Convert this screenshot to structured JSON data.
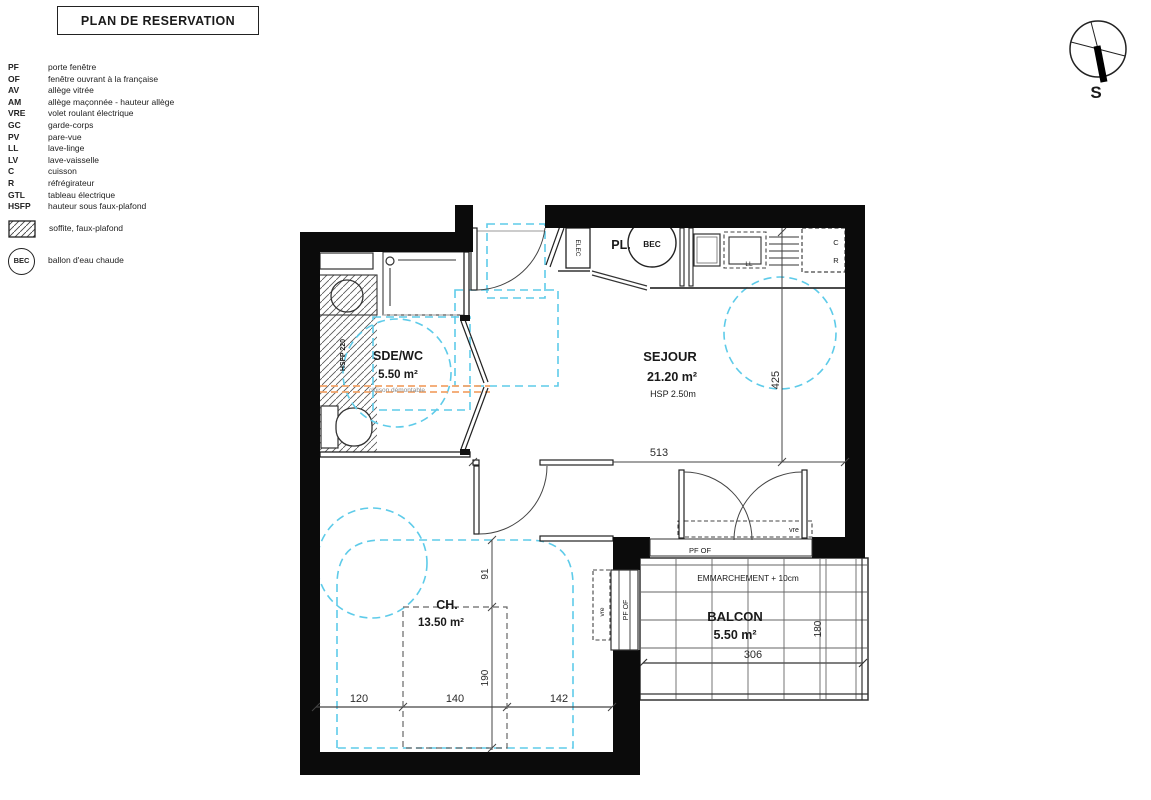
{
  "title": "PLAN DE RESERVATION",
  "legend": {
    "items": [
      {
        "abbr": "PF",
        "label": "porte fenêtre"
      },
      {
        "abbr": "OF",
        "label": "fenêtre ouvrant à la française"
      },
      {
        "abbr": "AV",
        "label": "allège vitrée"
      },
      {
        "abbr": "AM",
        "label": "allège maçonnée - hauteur allège"
      },
      {
        "abbr": "VRE",
        "label": "volet roulant électrique"
      },
      {
        "abbr": "GC",
        "label": "garde-corps"
      },
      {
        "abbr": "PV",
        "label": "pare-vue"
      },
      {
        "abbr": "LL",
        "label": "lave-linge"
      },
      {
        "abbr": "LV",
        "label": "lave-vaisselle"
      },
      {
        "abbr": "C",
        "label": "cuisson"
      },
      {
        "abbr": "R",
        "label": "réfrégirateur"
      },
      {
        "abbr": "GTL",
        "label": "tableau électrique"
      },
      {
        "abbr": "HSFP",
        "label": "hauteur sous faux-plafond"
      }
    ],
    "soffit_label": "soffite, faux-plafond",
    "bec_abbr": "BEC",
    "bec_label": "ballon d'eau chaude"
  },
  "compass": {
    "south": "S"
  },
  "rooms": {
    "sdewc": {
      "name": "SDE/WC",
      "area": "5.50 m²"
    },
    "sejour": {
      "name": "SEJOUR",
      "area": "21.20 m²",
      "height": "HSP 2.50m"
    },
    "ch": {
      "name": "CH.",
      "area": "13.50 m²"
    },
    "balcon": {
      "name": "BALCON",
      "area": "5.50 m²",
      "note": "EMMARCHEMENT + 10cm"
    },
    "pl": {
      "name": "PL."
    }
  },
  "annotations": {
    "bec": "BEC",
    "elec": "ELEC",
    "ll": "LL",
    "c": "C",
    "r": "R",
    "hsfp": "HSFP 220",
    "cloison": "cloison démontable",
    "pf_of": "PF OF",
    "vre": "vre"
  },
  "dimensions": {
    "d513": "513",
    "d425": "425",
    "d120": "120",
    "d140": "140",
    "d142": "142",
    "d91": "91",
    "d190": "190",
    "d306": "306",
    "d180": "180"
  },
  "colors": {
    "wall": "#0b0b0b",
    "clearance": "#5ecbe9",
    "partition_orange": "#f2a469"
  }
}
